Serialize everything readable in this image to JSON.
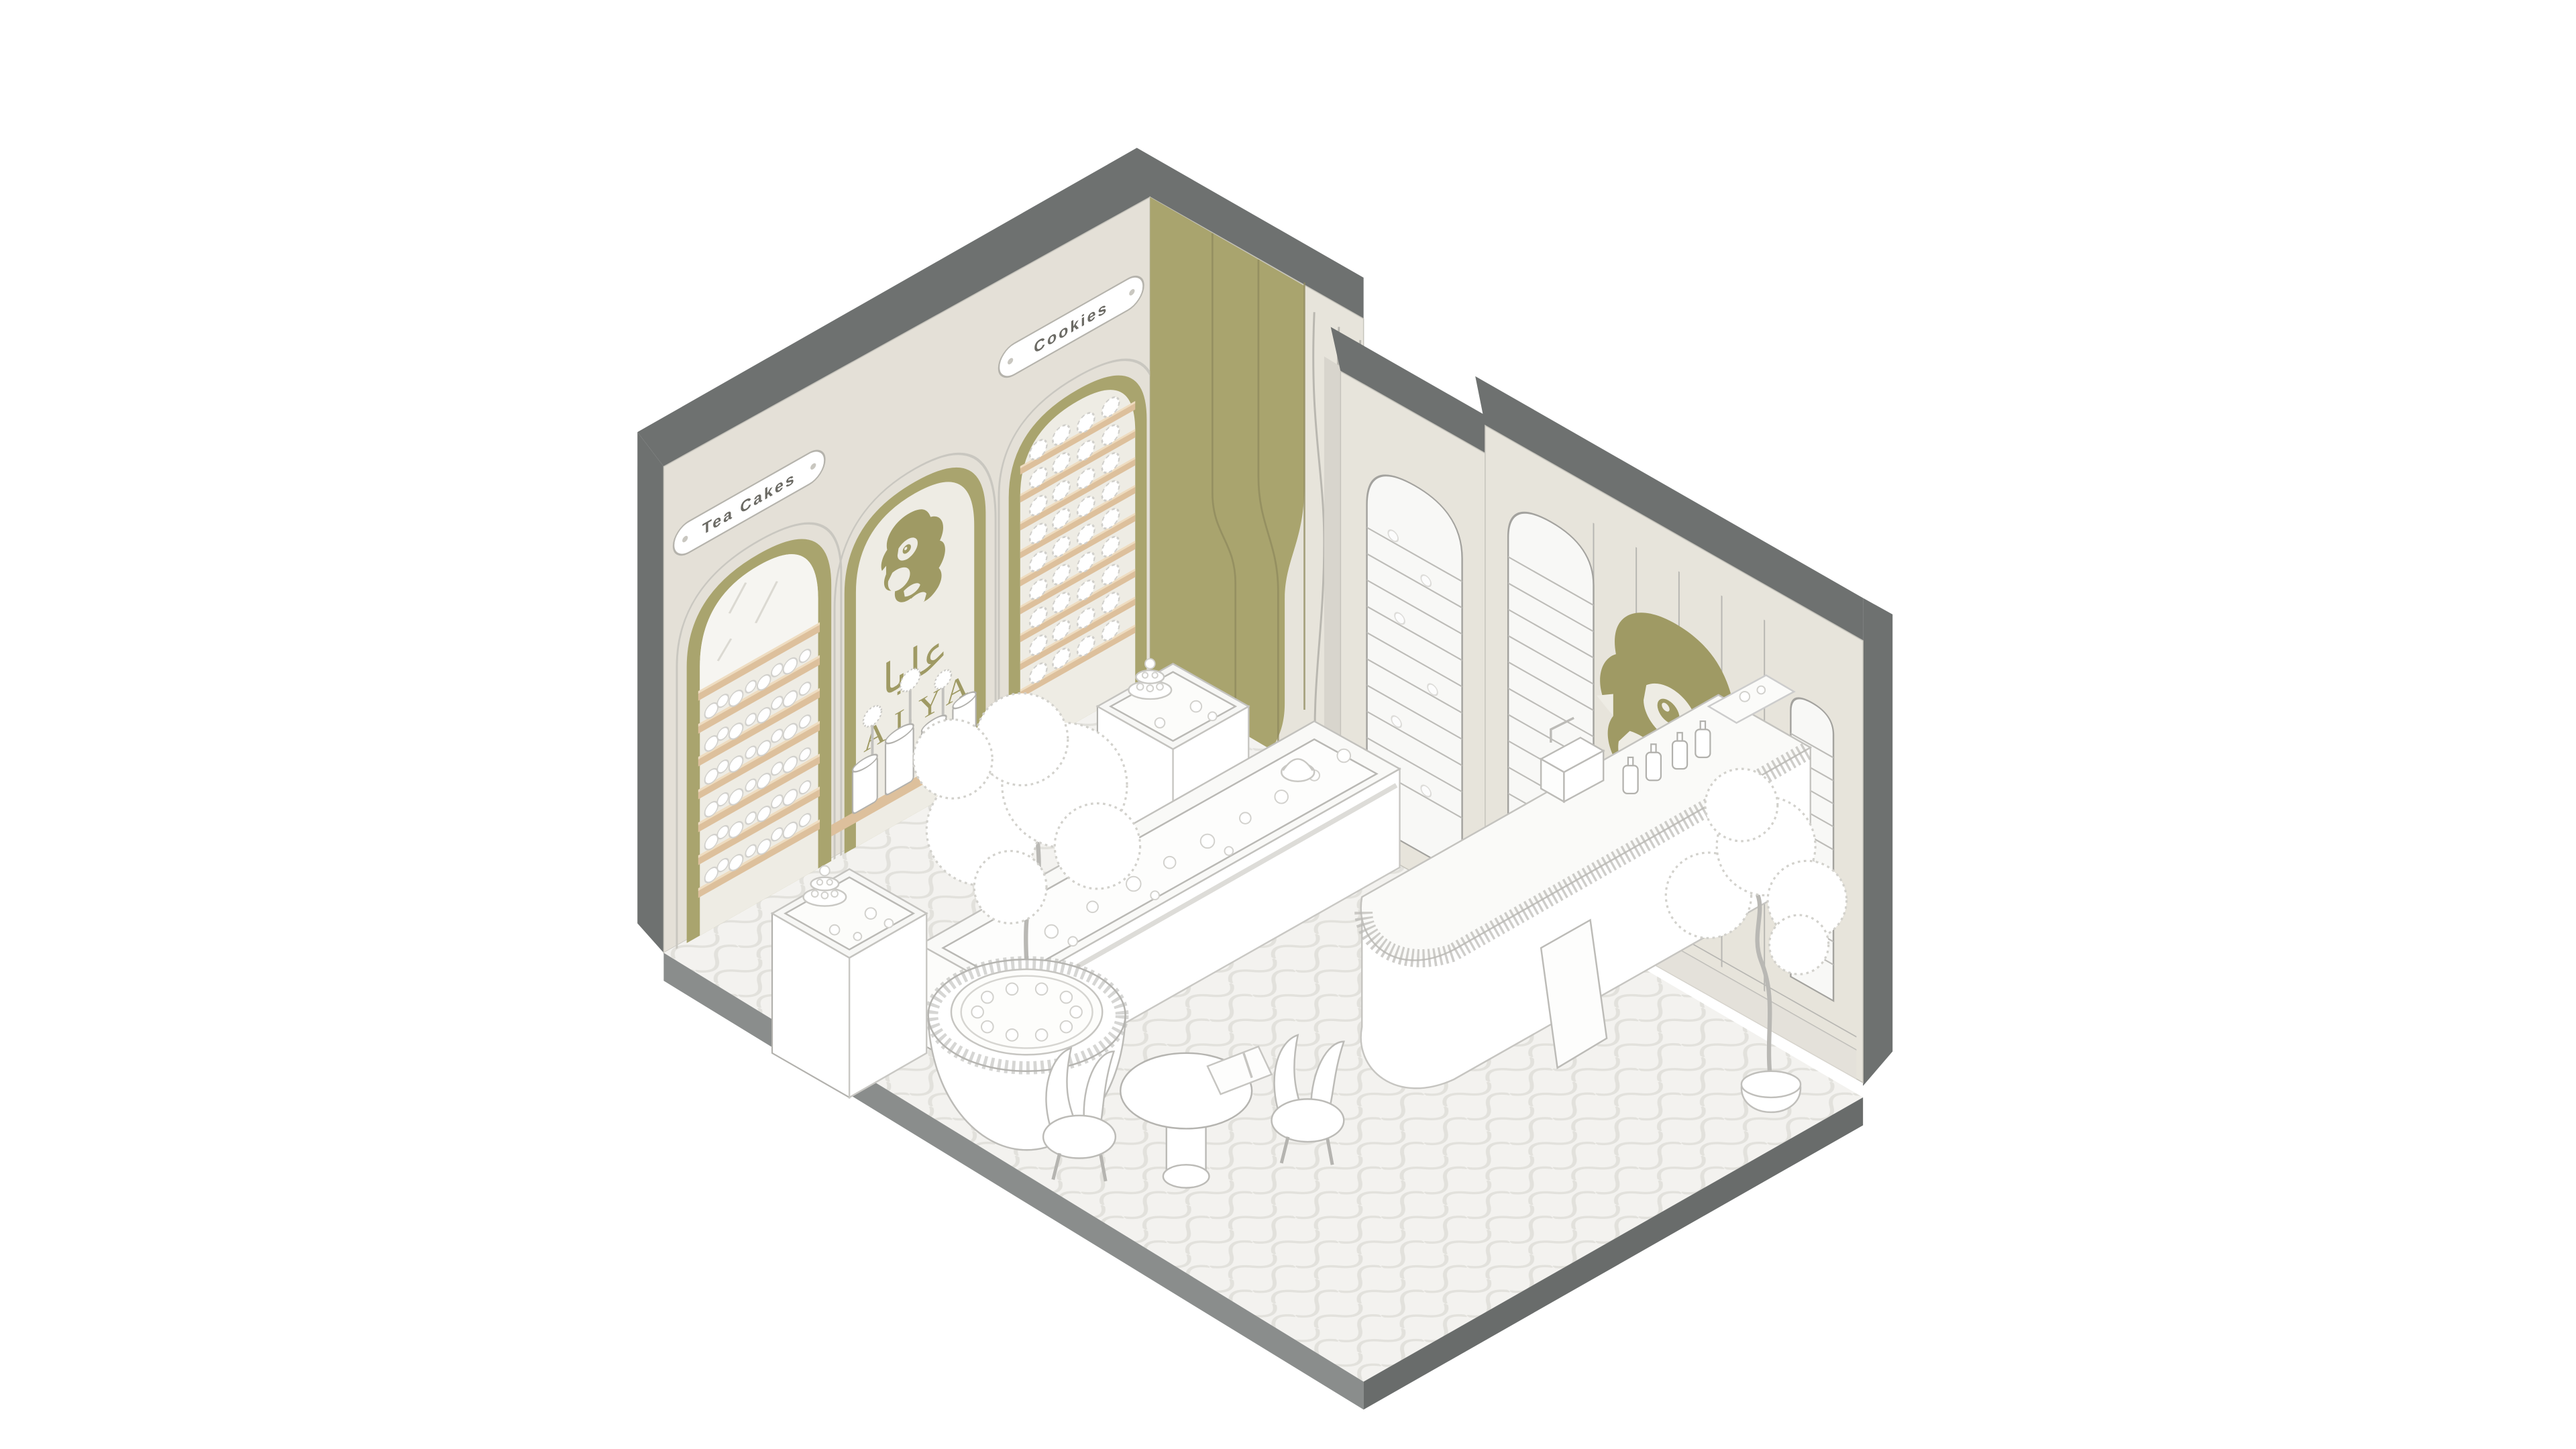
{
  "illustration": {
    "kind": "isometric-interior-rendering-patisserie",
    "brand": {
      "latin": "ALYA",
      "arabic": "عليا"
    },
    "signs": {
      "tea_cakes": "Tea Cakes",
      "cookies": "Cookies"
    },
    "motifs": {
      "logo": "woman-profile-face-motif",
      "wall_art": "woman-profile-face-mural"
    }
  },
  "palette": {
    "background": "#ffffff",
    "wall_left": "#e4e0d7",
    "wall_right": "#e7e4db",
    "wall_inner_light": "#eeece4",
    "olive_accent": "#a9a46e",
    "olive_deep": "#9f9a64",
    "wood_shelf": "#ddc09c",
    "wood_shelf_light": "#eedcc0",
    "structure_dark": "#6e7170",
    "floor_edge_left": "#8a8d8c",
    "floor_edge_right": "#696c6b",
    "floor_fill": "#f3f2ef",
    "floor_pattern": "#e2e1dc",
    "line_gray": "#b2b1ad",
    "case_fill": "#f8f8f6",
    "case_line": "#bdbcb8"
  }
}
